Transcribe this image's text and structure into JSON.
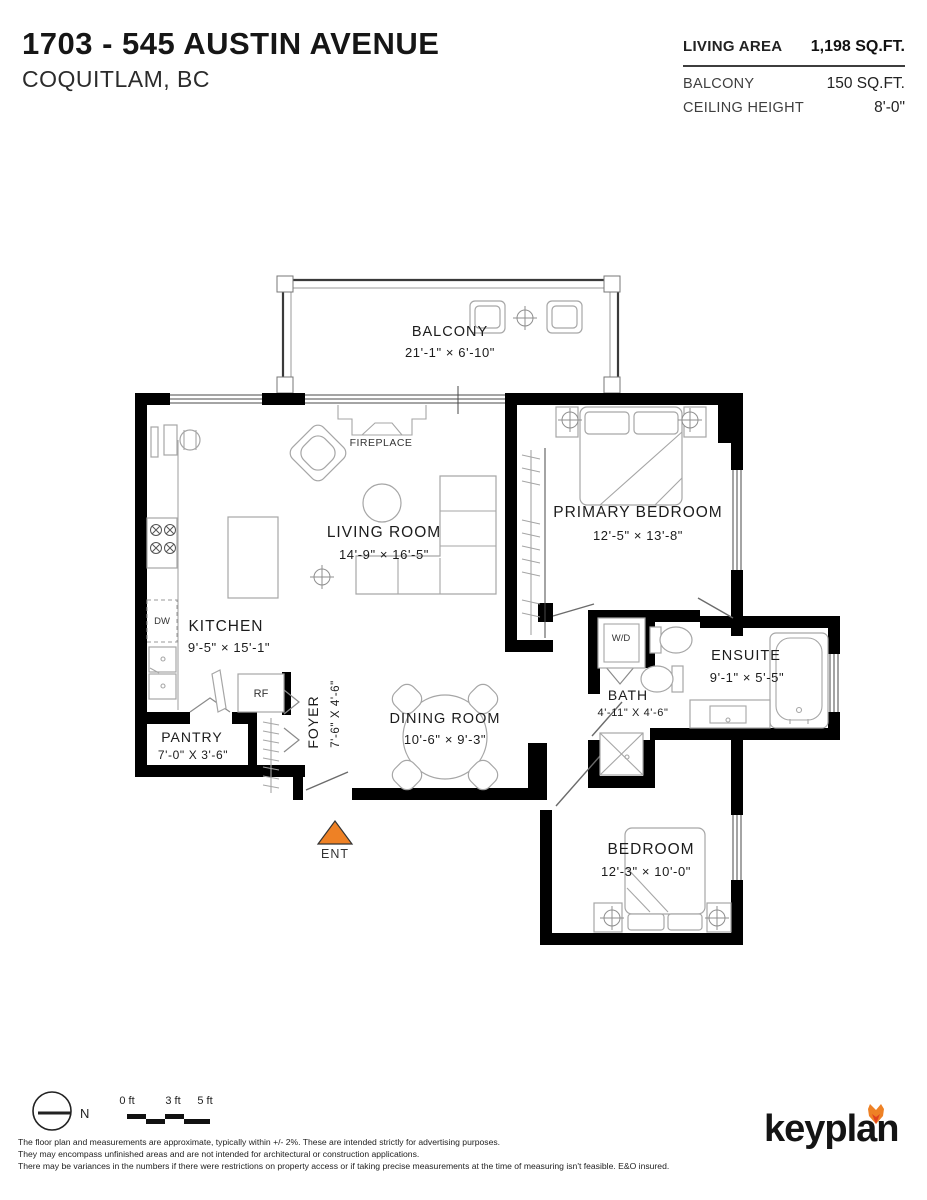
{
  "header": {
    "title": "1703 - 545 AUSTIN AVENUE",
    "subtitle": "COQUITLAM, BC",
    "stats": [
      {
        "label": "LIVING AREA",
        "value": "1,198 SQ.FT."
      },
      {
        "label": "BALCONY",
        "value": "150 SQ.FT."
      },
      {
        "label": "CEILING HEIGHT",
        "value": "8'-0\""
      }
    ]
  },
  "plan": {
    "rooms": {
      "balcony": {
        "name": "BALCONY",
        "dims": "21'-1\" × 6'-10\""
      },
      "living": {
        "name": "LIVING ROOM",
        "dims": "14'-9\" × 16'-5\""
      },
      "primary": {
        "name": "PRIMARY BEDROOM",
        "dims": "12'-5\" × 13'-8\""
      },
      "kitchen": {
        "name": "KITCHEN",
        "dims": "9'-5\" × 15'-1\""
      },
      "pantry": {
        "name": "PANTRY",
        "dims": "7'-0\" X 3'-6\""
      },
      "foyer": {
        "name": "FOYER",
        "dims": "7'-6\" X 4'-6\""
      },
      "dining": {
        "name": "DINING ROOM",
        "dims": "10'-6\" × 9'-3\""
      },
      "bath": {
        "name": "BATH",
        "dims": "4'-11\" X 4'-6\""
      },
      "ensuite": {
        "name": "ENSUITE",
        "dims": "9'-1\" × 5'-5\""
      },
      "bedroom": {
        "name": "BEDROOM",
        "dims": "12'-3\" × 10'-0\""
      }
    },
    "fixtures": {
      "fireplace": "FIREPLACE",
      "dishwasher": "DW",
      "fridge": "RF",
      "washer_dryer": "W/D"
    },
    "entry_label": "ENT",
    "colors": {
      "accent": "#EE8125",
      "accent_deep": "#E0421F",
      "wall": "#000000",
      "furniture_line": "#a6a6a6"
    }
  },
  "footer": {
    "north_label": "N",
    "scale": {
      "labels": [
        "0 ft",
        "3 ft",
        "5 ft"
      ]
    },
    "disclaimer": [
      "The floor plan and measurements are approximate, typically within +/- 2%. These are intended strictly for advertising purposes.",
      "They may encompass unfinished areas and are not intended for architectural or construction applications.",
      "There may be variances in the numbers if there were restrictions on property access or if taking precise measurements at the time of measuring isn't feasible. E&O insured."
    ],
    "logo_text": "keyplan"
  }
}
